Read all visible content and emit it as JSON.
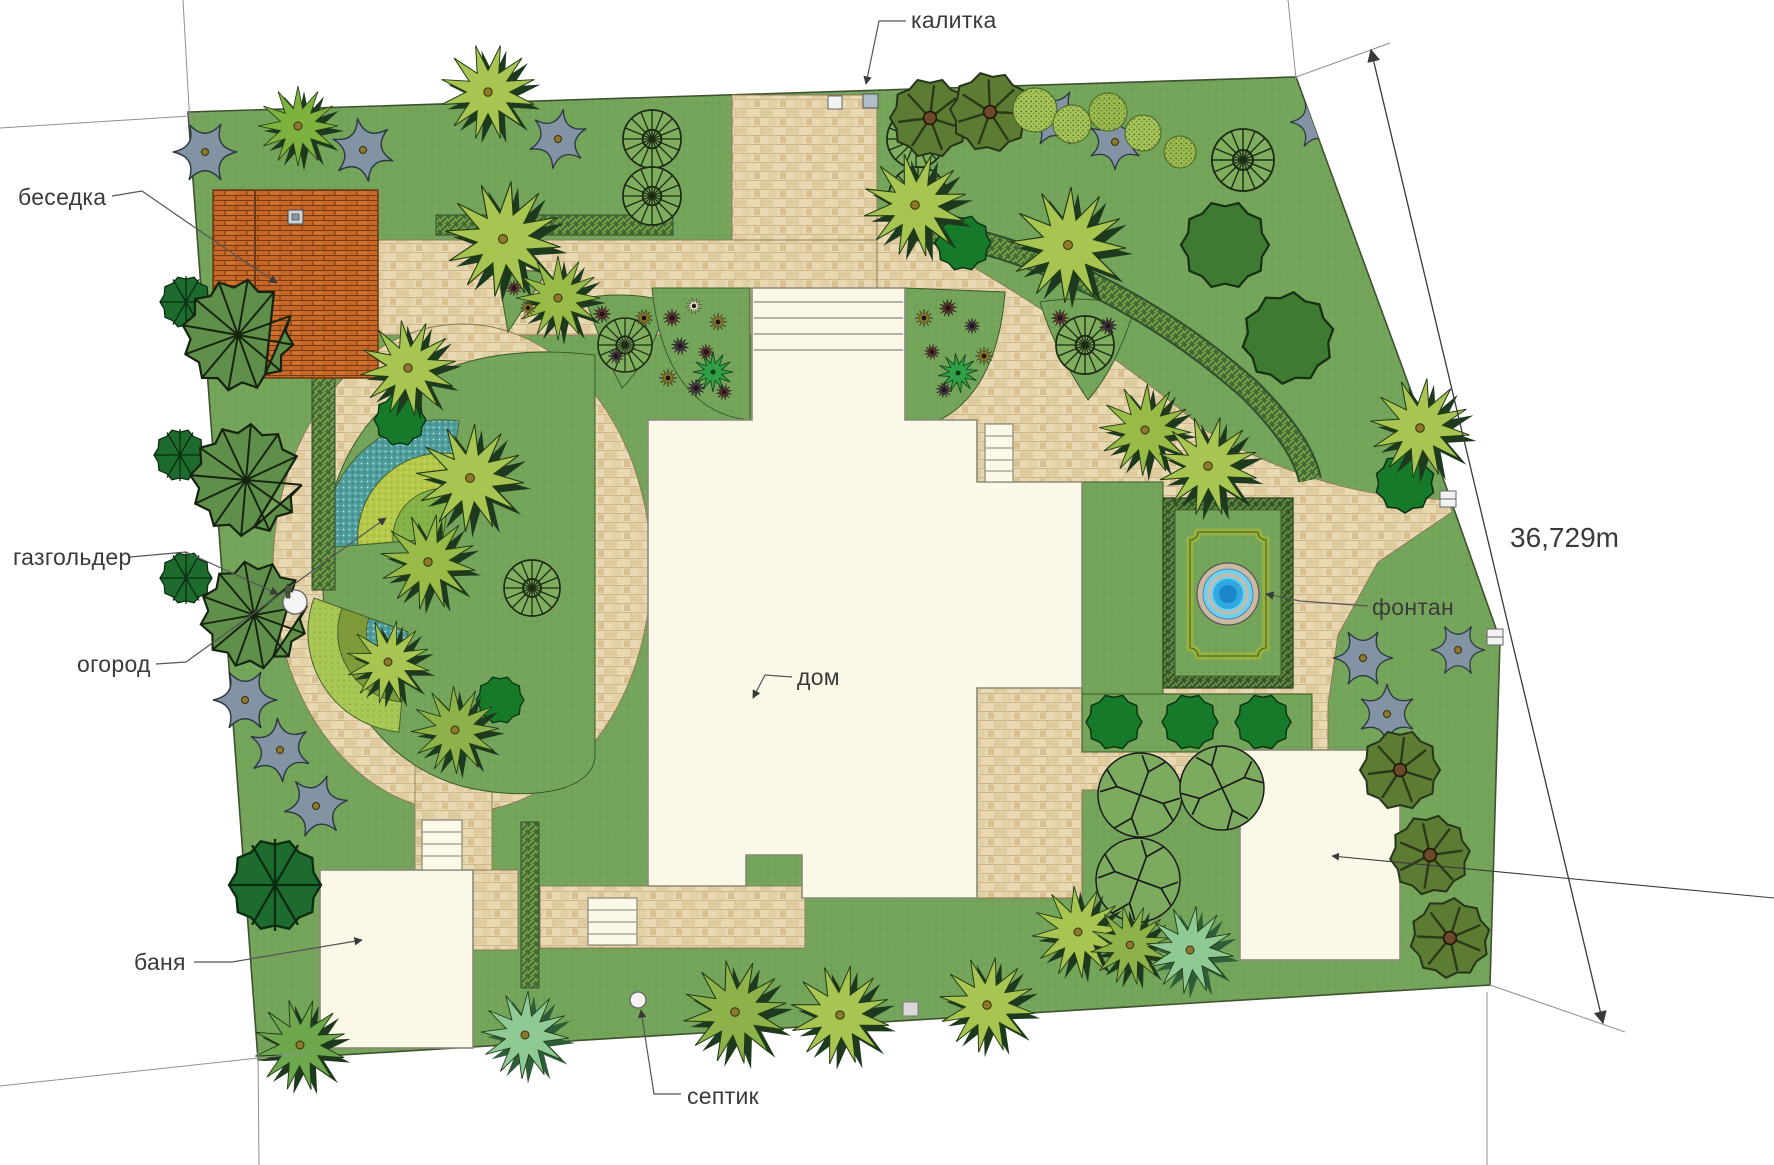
{
  "plan": {
    "labels": {
      "gazebo": "беседка",
      "gate": "калитка",
      "gasholder": "газгольдер",
      "garden": "огород",
      "bathhouse": "баня",
      "septic": "септик",
      "house": "дом",
      "fountain": "фонтан"
    },
    "dimension": {
      "right_side_length": "36,729m"
    },
    "colors": {
      "lawn": "#74a45a",
      "paving": "#e9d9b2",
      "roof": "#c76727",
      "water": "#6fd0f2",
      "groundcover": "#8293a3",
      "label_text": "#3a3a3a"
    }
  }
}
